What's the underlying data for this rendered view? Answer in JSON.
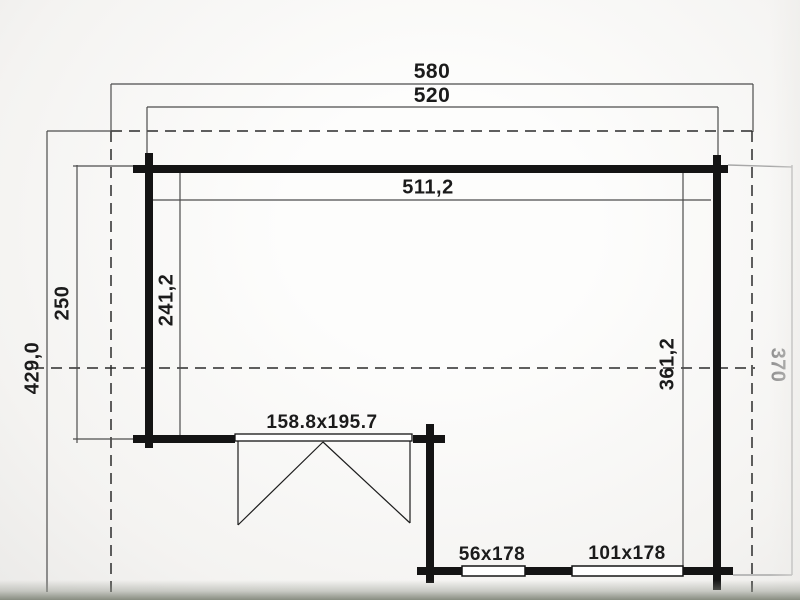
{
  "dimensions": {
    "roof_width": "580",
    "outer_width": "520",
    "inner_width": "511,2",
    "roof_depth": "429,0",
    "left_outer_depth": "250",
    "left_inner_depth": "241,2",
    "right_inner_depth": "361,2",
    "right_outer_depth": "370",
    "door_size": "158.8x195.7",
    "window_small_size": "56x178",
    "window_large_size": "101x178"
  },
  "colors": {
    "wall": "#141414",
    "dimension_line": "#4d4d4d",
    "dashed_outline": "#2b2b2b",
    "faded_line": "#a8a8a8",
    "label_text": "#1b1b1b",
    "shadow_band": "#878c80"
  }
}
